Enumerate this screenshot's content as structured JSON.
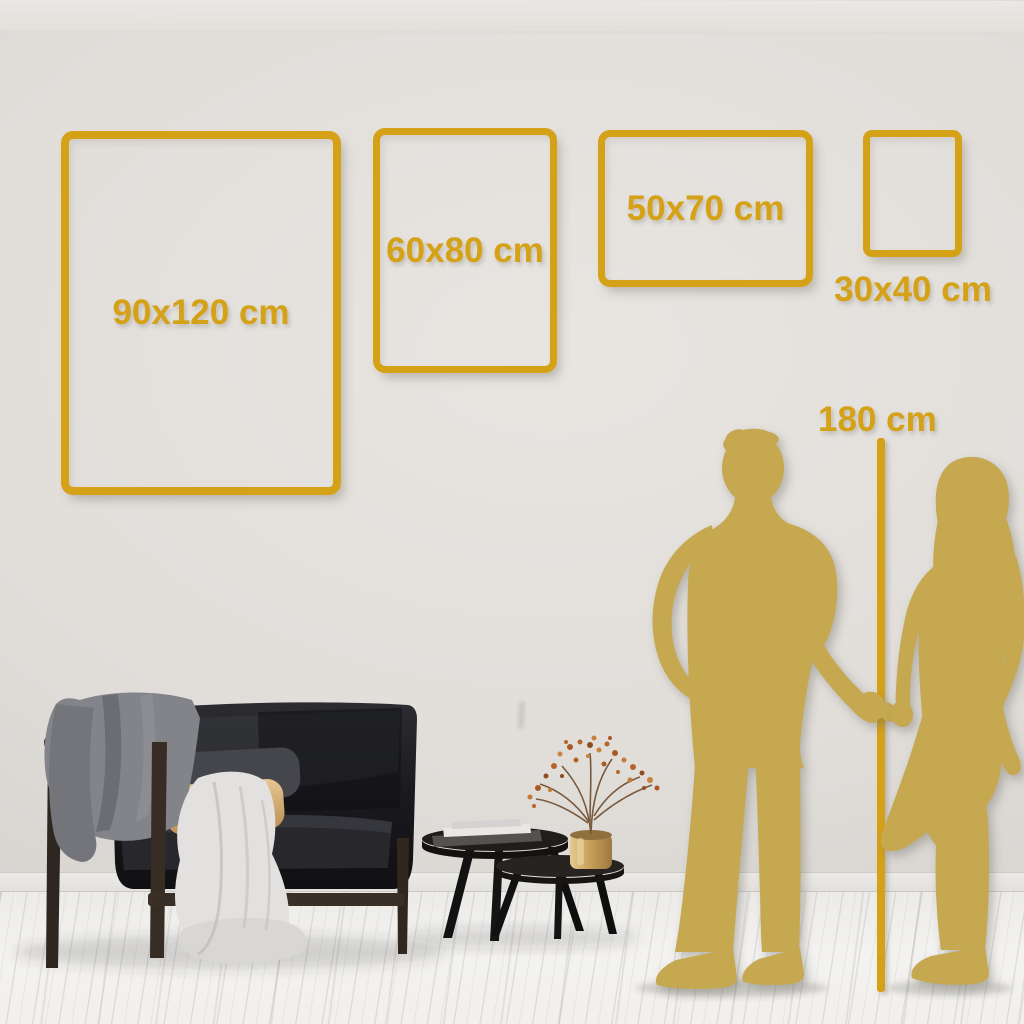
{
  "size_guide": {
    "frames": [
      {
        "label": "90x120 cm",
        "width_cm": 90,
        "height_cm": 120
      },
      {
        "label": "60x80 cm",
        "width_cm": 60,
        "height_cm": 80
      },
      {
        "label": "50x70 cm",
        "width_cm": 50,
        "height_cm": 70
      },
      {
        "label": "30x40 cm",
        "width_cm": 30,
        "height_cm": 40
      }
    ],
    "height_marker": {
      "label": "180 cm",
      "height_cm": 180
    }
  },
  "scene": {
    "objects": [
      "velvet-sofa",
      "gray-throw-blanket",
      "light-draped-blanket",
      "charcoal-pillow",
      "tan-pillow",
      "nesting-coffee-tables",
      "stacked-books",
      "brass-vase-with-dried-berry-branches",
      "man-silhouette",
      "woman-silhouette",
      "height-reference-line"
    ]
  },
  "colors": {
    "accent_gold": "#D5A117",
    "silhouette_gold": "#C5A850",
    "wall": "#DEDBD7",
    "floor": "#F2F1EF",
    "sofa_velvet": "#1A1A1E",
    "pillow_tan": "#D9B87E",
    "pillow_charcoal": "#44464C",
    "blanket_light": "#E2E1DF",
    "blanket_gray": "#83848A",
    "wood_brown": "#3A2F26",
    "vase_brass": "#C9A25C",
    "berry_rust": "#B5652A"
  }
}
